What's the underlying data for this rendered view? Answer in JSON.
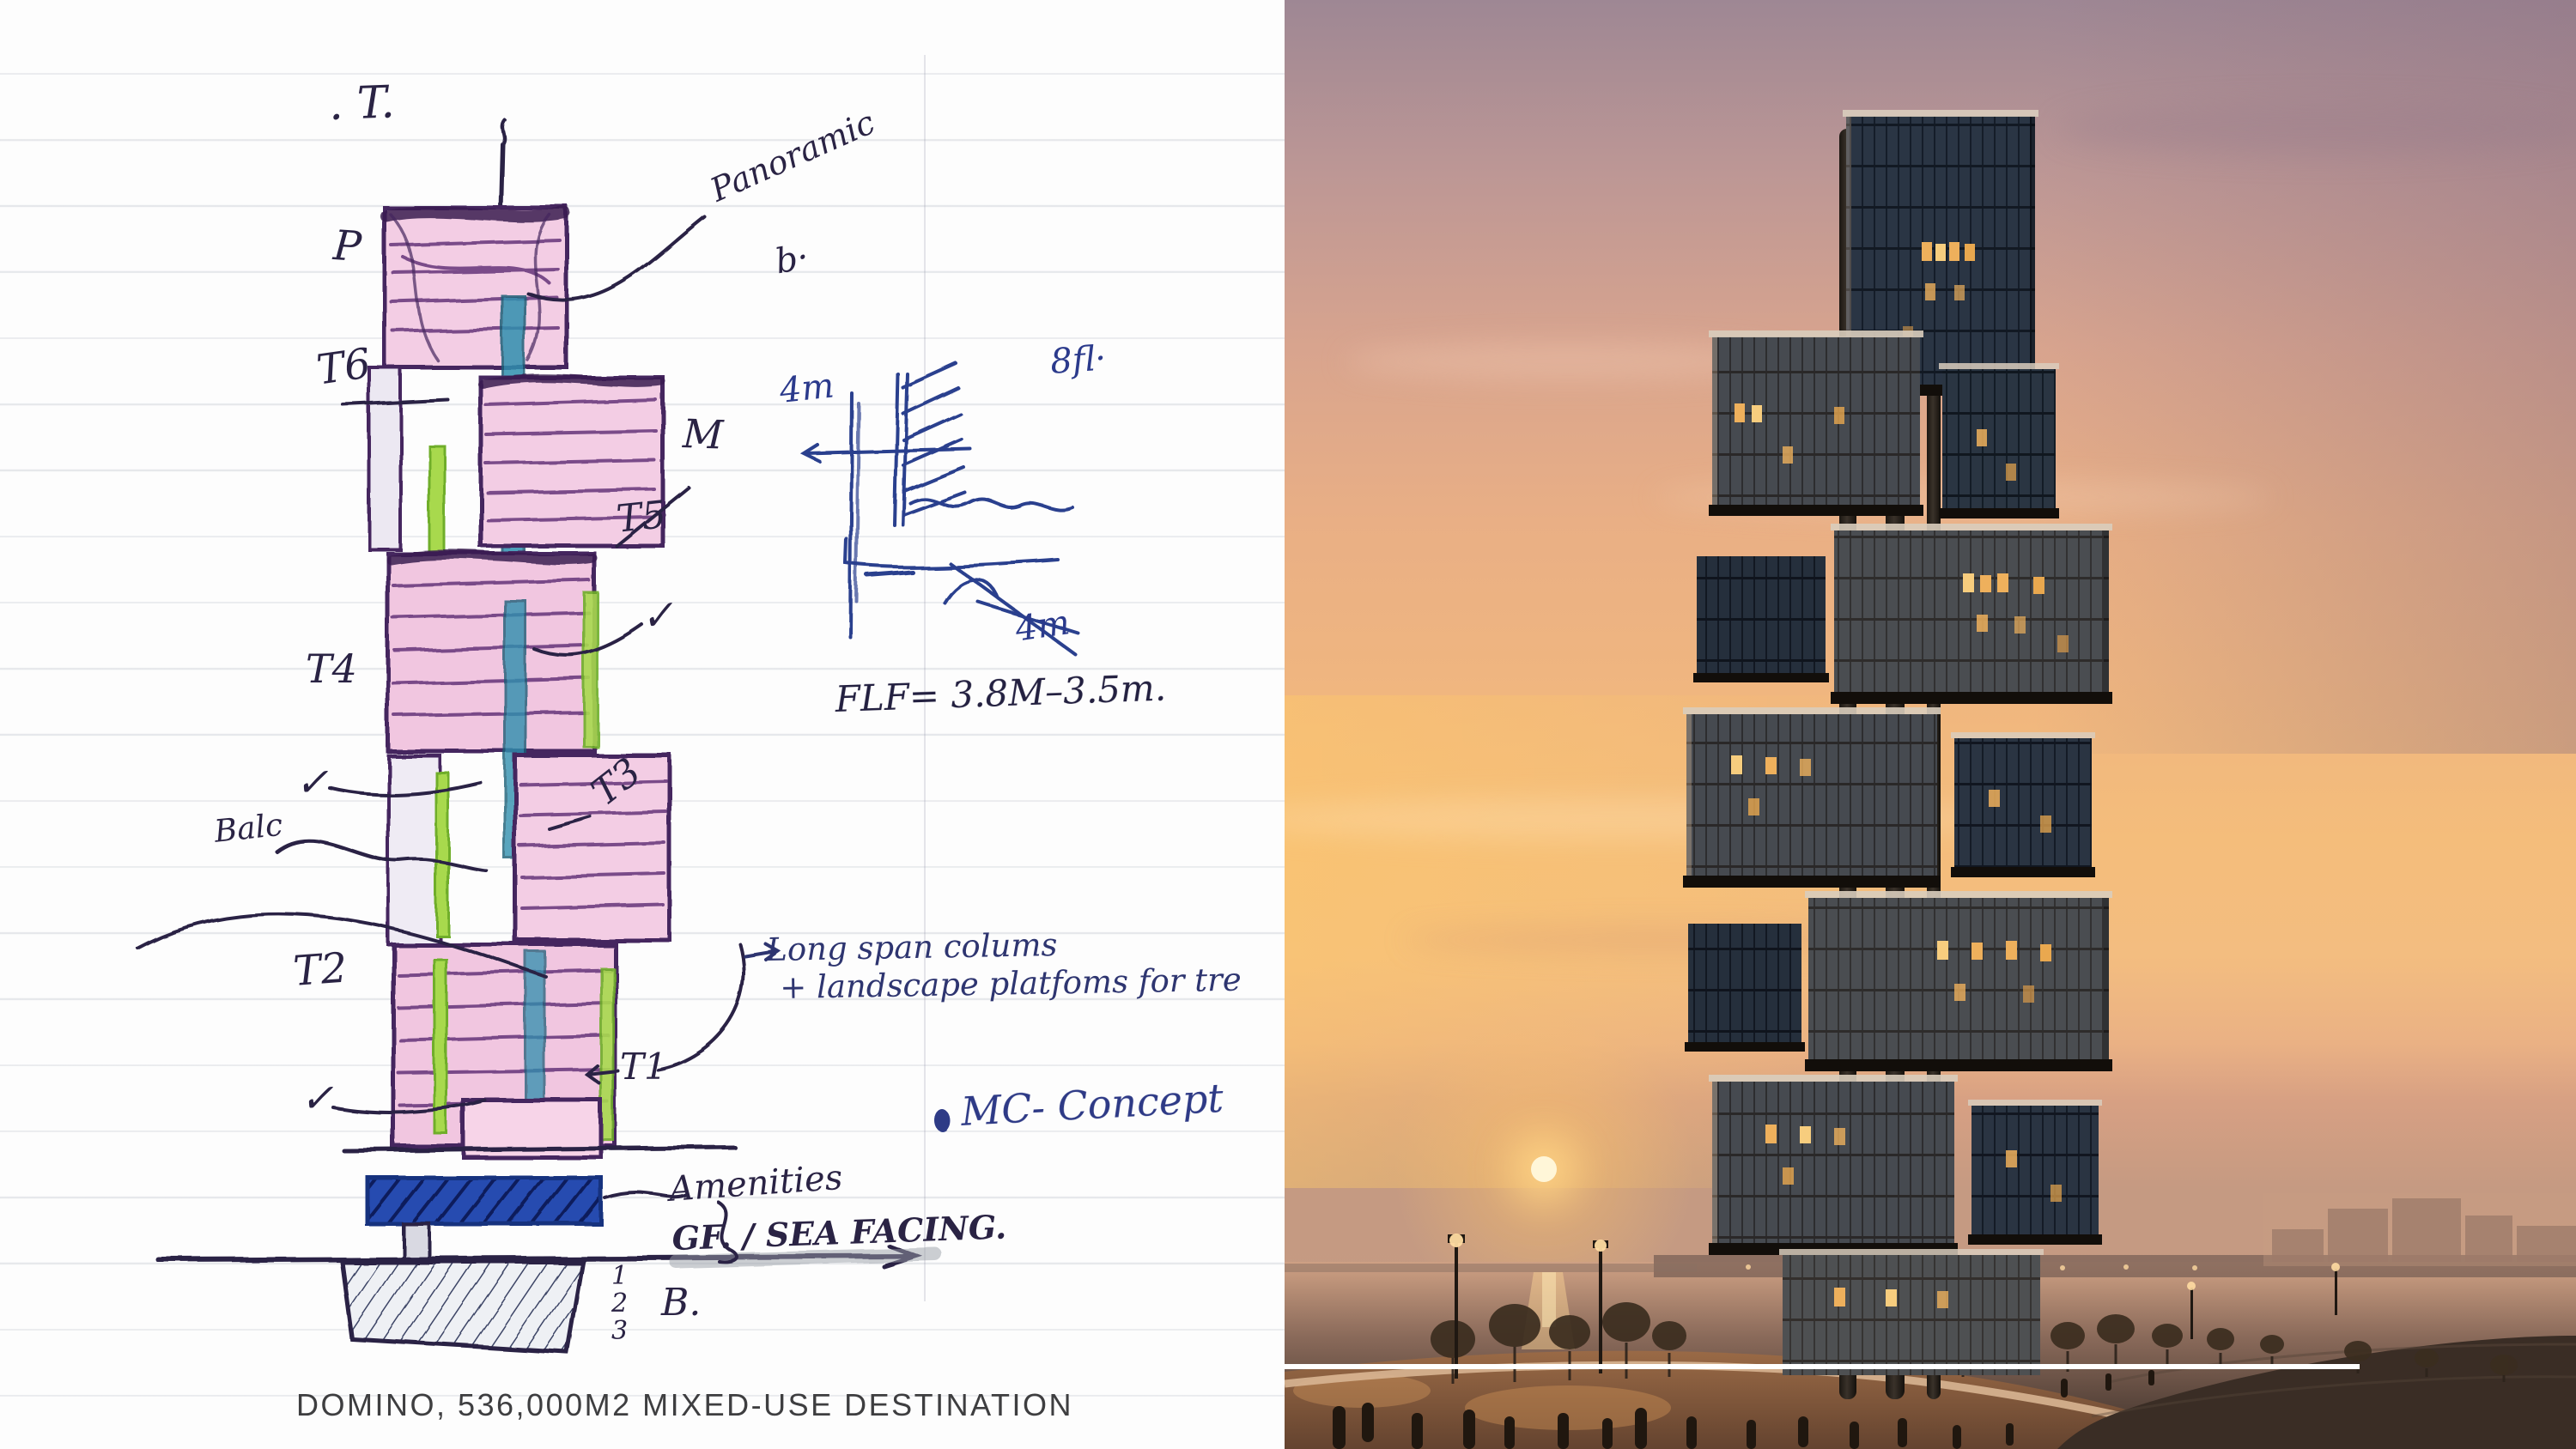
{
  "caption": "DOMINO, 536,000M2 MIXED-USE DESTINATION",
  "sketch": {
    "labels": {
      "top": ". T.",
      "p": "P",
      "panoramic": "Panoramic",
      "b_upper": "b·",
      "t6": "T6",
      "m": "M",
      "t5": "T5",
      "t4": "T4",
      "t3": "T3",
      "t2": "T2",
      "t1": "T1",
      "check": "✓",
      "balc": "Balc",
      "dim_top": "4m",
      "floors": "8fl·",
      "dim_bottom": "4m",
      "flf": "FLF= 3.8M–3.5m.",
      "note_line1": "Long span colums",
      "note_line2": "+ landscape platfoms for tre",
      "concept": "MC- Concept",
      "amenities": "Amenities",
      "gf": "GF. / SEA FACING.",
      "basement": "B.",
      "lvl1": "1",
      "lvl2": "2",
      "lvl3": "3"
    },
    "ink": "#2a2344",
    "blue_ink": "#2b3a8c",
    "pink": "#f2c9e2",
    "green": "#a8d94e",
    "teal": "#2f8fae",
    "blue_slab": "#274bb0"
  },
  "photo": {
    "sky_top": "#9e8794",
    "sky_mid": "#eab083",
    "sky_low": "#f6c477",
    "sun": "#fff6d8",
    "sea": "#b98d77",
    "water_dark": "#3a2d25",
    "glass": "#323e4c",
    "lit_window": "#eeb05c",
    "mast": "#272119",
    "divider": "#ffffff"
  }
}
